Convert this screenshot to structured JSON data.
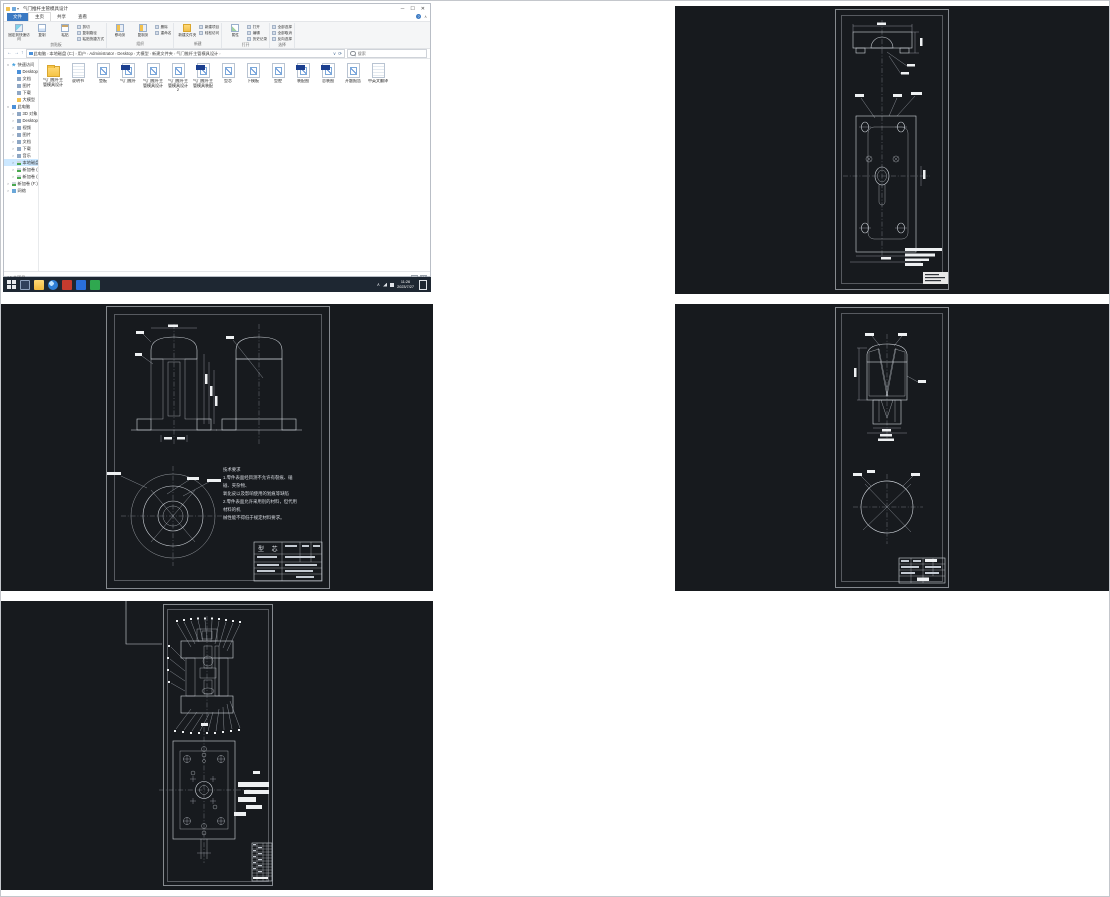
{
  "explorer": {
    "title": "气门推杆主管模具设计",
    "window_controls": {
      "minimize": "─",
      "maximize": "☐",
      "close": "✕"
    },
    "menu_tabs": [
      {
        "label": "文件",
        "style": "accent"
      },
      {
        "label": "主页",
        "style": "active"
      },
      {
        "label": "共享",
        "style": ""
      },
      {
        "label": "查看",
        "style": ""
      }
    ],
    "ribbon_extras": {
      "help": "?",
      "collapse": "∧"
    },
    "ribbon_groups": [
      {
        "label": "剪贴板",
        "big": [
          {
            "label": "固定到快速访问",
            "icon": "pin"
          },
          {
            "label": "复制",
            "icon": "copy"
          },
          {
            "label": "粘贴",
            "icon": "paste"
          }
        ],
        "stack": [
          "剪切",
          "复制路径",
          "粘贴快捷方式"
        ]
      },
      {
        "label": "组织",
        "big": [
          {
            "label": "移动到",
            "icon": "move"
          },
          {
            "label": "复制到",
            "icon": "move"
          }
        ],
        "stack": [
          "删除",
          "重命名"
        ]
      },
      {
        "label": "新建",
        "big": [
          {
            "label": "新建文件夹",
            "icon": "newf"
          }
        ],
        "stack": [
          "新建项目",
          "轻松访问"
        ]
      },
      {
        "label": "打开",
        "big": [
          {
            "label": "属性",
            "icon": "prop"
          }
        ],
        "stack": [
          "打开",
          "编辑",
          "历史记录"
        ]
      },
      {
        "label": "选择",
        "big": [],
        "stack": [
          "全部选择",
          "全部取消",
          "反向选择"
        ]
      }
    ],
    "breadcrumb": [
      "此电脑",
      "本地磁盘 (C:)",
      "用户",
      "Administrator",
      "Desktop",
      "大模型",
      "新建文件夹",
      "气门推杆主管模具设计"
    ],
    "search_placeholder": "搜索",
    "sidebar": [
      {
        "label": "快速访问",
        "icon": "star",
        "level": 0,
        "exp": "∨"
      },
      {
        "label": "Desktop",
        "icon": "pc",
        "level": 1,
        "exp": ""
      },
      {
        "label": "文档",
        "icon": "plain",
        "level": 1,
        "exp": ""
      },
      {
        "label": "图片",
        "icon": "plain",
        "level": 1,
        "exp": ""
      },
      {
        "label": "下载",
        "icon": "plain",
        "level": 1,
        "exp": ""
      },
      {
        "label": "大模型",
        "icon": "folder",
        "level": 1,
        "exp": ""
      },
      {
        "label": "此电脑",
        "icon": "pc",
        "level": 0,
        "exp": "∨"
      },
      {
        "label": "3D 对象",
        "icon": "plain",
        "level": 1,
        "exp": ">"
      },
      {
        "label": "Desktop",
        "icon": "plain",
        "level": 1,
        "exp": ">"
      },
      {
        "label": "视频",
        "icon": "plain",
        "level": 1,
        "exp": ">"
      },
      {
        "label": "图片",
        "icon": "plain",
        "level": 1,
        "exp": ">"
      },
      {
        "label": "文档",
        "icon": "plain",
        "level": 1,
        "exp": ">"
      },
      {
        "label": "下载",
        "icon": "plain",
        "level": 1,
        "exp": ">"
      },
      {
        "label": "音乐",
        "icon": "plain",
        "level": 1,
        "exp": ">"
      },
      {
        "label": "本地磁盘 (C:)",
        "icon": "drive",
        "level": 1,
        "exp": ">",
        "selected": true
      },
      {
        "label": "新加卷 (D:)",
        "icon": "drive",
        "level": 1,
        "exp": ">"
      },
      {
        "label": "新加卷 (E:)",
        "icon": "drive",
        "level": 1,
        "exp": ">"
      },
      {
        "label": "新加卷 (F:)",
        "icon": "drive",
        "level": 0,
        "exp": ">"
      },
      {
        "label": "网络",
        "icon": "net",
        "level": 0,
        "exp": ">"
      }
    ],
    "files": [
      {
        "name": "气门推杆主管模具设计",
        "type": "folder"
      },
      {
        "name": "说明书",
        "type": "doc"
      },
      {
        "name": "垫板",
        "type": "dwg"
      },
      {
        "name": "气门推杆",
        "type": "dwgb"
      },
      {
        "name": "气门推杆主管模具设计",
        "type": "dwg"
      },
      {
        "name": "气门推杆主管模具设计2",
        "type": "dwg"
      },
      {
        "name": "气门推杆主管模具装配",
        "type": "dwgb"
      },
      {
        "name": "型芯",
        "type": "dwg"
      },
      {
        "name": "下模板",
        "type": "dwg"
      },
      {
        "name": "型腔",
        "type": "dwg"
      },
      {
        "name": "装配图",
        "type": "dwgb"
      },
      {
        "name": "总装图",
        "type": "dwgb"
      },
      {
        "name": "开题报告",
        "type": "dwg"
      },
      {
        "name": "中英文翻译",
        "type": "doc"
      }
    ],
    "status": "14 个项目"
  },
  "taskbar": {
    "apps": [
      "start-icon",
      "task-view-icon",
      "file-explorer-icon",
      "browser-icon",
      "red-app-icon",
      "blue-app-icon",
      "green-app-icon"
    ],
    "tray_icons": [
      "chevron-up-icon",
      "network-icon",
      "volume-icon"
    ],
    "clock_time": "11:26",
    "clock_date": "2023/7/27"
  },
  "cad": {
    "colors": {
      "background": "#171a1e",
      "line": "#cfd4da",
      "hatch_green": "#3fae49"
    },
    "tech_requirements": {
      "title": "技术要求",
      "lines": [
        "1.零件表面经目测不允许有裂痕、磕碰、夹杂物、",
        "氧化皮以及影响使用的划痕等缺陷",
        "2.零件表面允许采用别的材料，但代用材料的机",
        "械性能不得低于规定材料要求。"
      ]
    },
    "core_part_name": "型 芯"
  }
}
